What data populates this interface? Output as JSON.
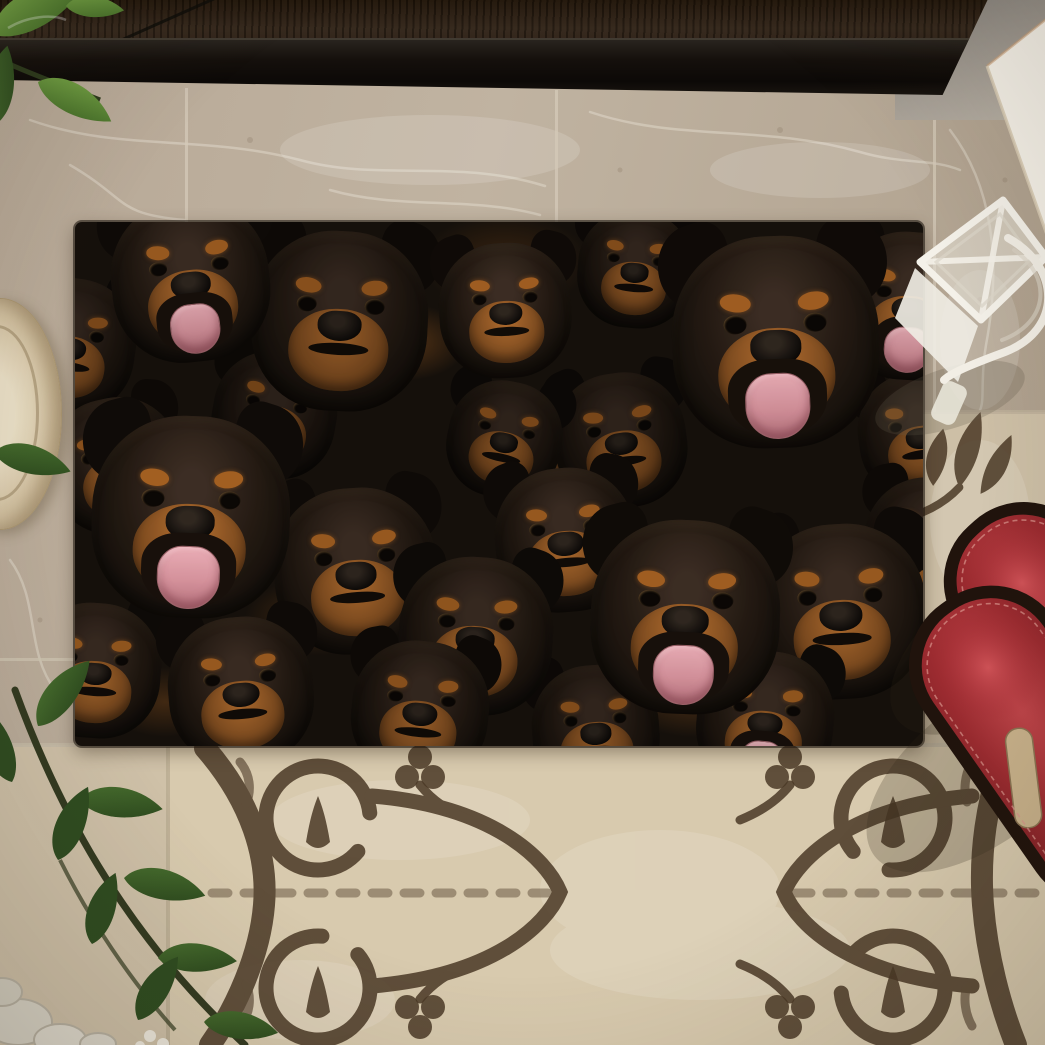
{
  "scene": {
    "type": "product-photo",
    "description": "Top-down photo of a doormat printed with a dense collage of Rottweiler dog faces, lying on beige marble tile in front of a dark door threshold. Below the mat is an ornate brown scrollwork tile medallion. A pair of red slide sandals and a white wire candle lantern sit to the right, a white box leans in the top-right corner, green houseplant sprigs enter from the left, and a cream plate pokes in at the left edge with white pebbles in the bottom-left corner.",
    "objects": [
      {
        "name": "door-threshold",
        "color": "#1a1410"
      },
      {
        "name": "door-panel",
        "color": "#2e2115"
      },
      {
        "name": "wall-corner",
        "color": "#8f8a83"
      },
      {
        "name": "marble-floor",
        "color": "#b3a491"
      },
      {
        "name": "rottweiler-doormat",
        "color": "#15100b",
        "accent_tan": "#96581f",
        "tongue_pink": "#c4868f",
        "dog_count": 24
      },
      {
        "name": "ornate-tile-medallion",
        "background": "#d8caae",
        "pattern_color": "#4b3926"
      },
      {
        "name": "red-slide-sandals",
        "color": "#9e2c31",
        "sole_color": "#20130c",
        "insole_color": "#c9b28b",
        "count": 2
      },
      {
        "name": "white-wire-lantern",
        "color": "#f2eee5"
      },
      {
        "name": "white-box",
        "color": "#f6f2e9"
      },
      {
        "name": "plant-sprig-top-left",
        "color": "#5d8f35"
      },
      {
        "name": "plant-sprig-bottom-left",
        "color": "#2e4c20"
      },
      {
        "name": "cream-plate",
        "color": "#dccfb2"
      },
      {
        "name": "white-pebbles",
        "color": "#d9d4c6"
      }
    ]
  },
  "palette": {
    "marble": "#b3a491",
    "marble_vein": "#efe9dd",
    "door": "#2e2115",
    "sill": "#15100c",
    "mat_black": "#15100b",
    "mat_tan": "#96581f",
    "tongue": "#c4868f",
    "tile_cream": "#d8caae",
    "tile_pattern": "#4b3926",
    "sandal_red": "#9e2c31",
    "leaf_green": "#3f6628",
    "lantern_white": "#f2eee5"
  },
  "doormat": {
    "label": "A Bunch Of Rottweilers doormat",
    "fields": [
      "x",
      "y",
      "size",
      "rotate_deg",
      "tongue",
      "brightness",
      "z"
    ],
    "dogs": [
      [
        115,
        55,
        180,
        -6,
        1,
        1.0,
        3
      ],
      [
        -5,
        120,
        150,
        8,
        0,
        0.8,
        2
      ],
      [
        265,
        95,
        200,
        3,
        0,
        0.9,
        2
      ],
      [
        430,
        85,
        150,
        -3,
        0,
        1.05,
        3
      ],
      [
        560,
        45,
        130,
        5,
        0,
        0.85,
        1
      ],
      [
        700,
        115,
        235,
        -2,
        1,
        1.05,
        4
      ],
      [
        835,
        80,
        165,
        4,
        1,
        1.0,
        3
      ],
      [
        200,
        190,
        140,
        10,
        0,
        0.75,
        1
      ],
      [
        545,
        215,
        150,
        -8,
        0,
        0.8,
        1
      ],
      [
        40,
        240,
        150,
        -12,
        0,
        0.9,
        2
      ],
      [
        115,
        290,
        225,
        2,
        1,
        1.08,
        5
      ],
      [
        280,
        345,
        185,
        -4,
        0,
        1.0,
        4
      ],
      [
        400,
        410,
        175,
        3,
        0,
        0.95,
        4
      ],
      [
        490,
        315,
        160,
        -5,
        0,
        1.0,
        3
      ],
      [
        610,
        390,
        215,
        2,
        1,
        1.06,
        5
      ],
      [
        765,
        385,
        195,
        -3,
        0,
        1.0,
        4
      ],
      [
        855,
        320,
        150,
        6,
        0,
        0.9,
        3
      ],
      [
        20,
        445,
        150,
        4,
        0,
        0.95,
        4
      ],
      [
        165,
        465,
        165,
        -5,
        0,
        1.0,
        4
      ],
      [
        345,
        485,
        155,
        6,
        0,
        0.9,
        4
      ],
      [
        520,
        505,
        145,
        -4,
        0,
        0.85,
        3
      ],
      [
        690,
        495,
        155,
        5,
        1,
        0.95,
        4
      ],
      [
        845,
        210,
        140,
        -8,
        0,
        0.85,
        2
      ],
      [
        430,
        215,
        130,
        12,
        0,
        0.8,
        1
      ]
    ]
  }
}
